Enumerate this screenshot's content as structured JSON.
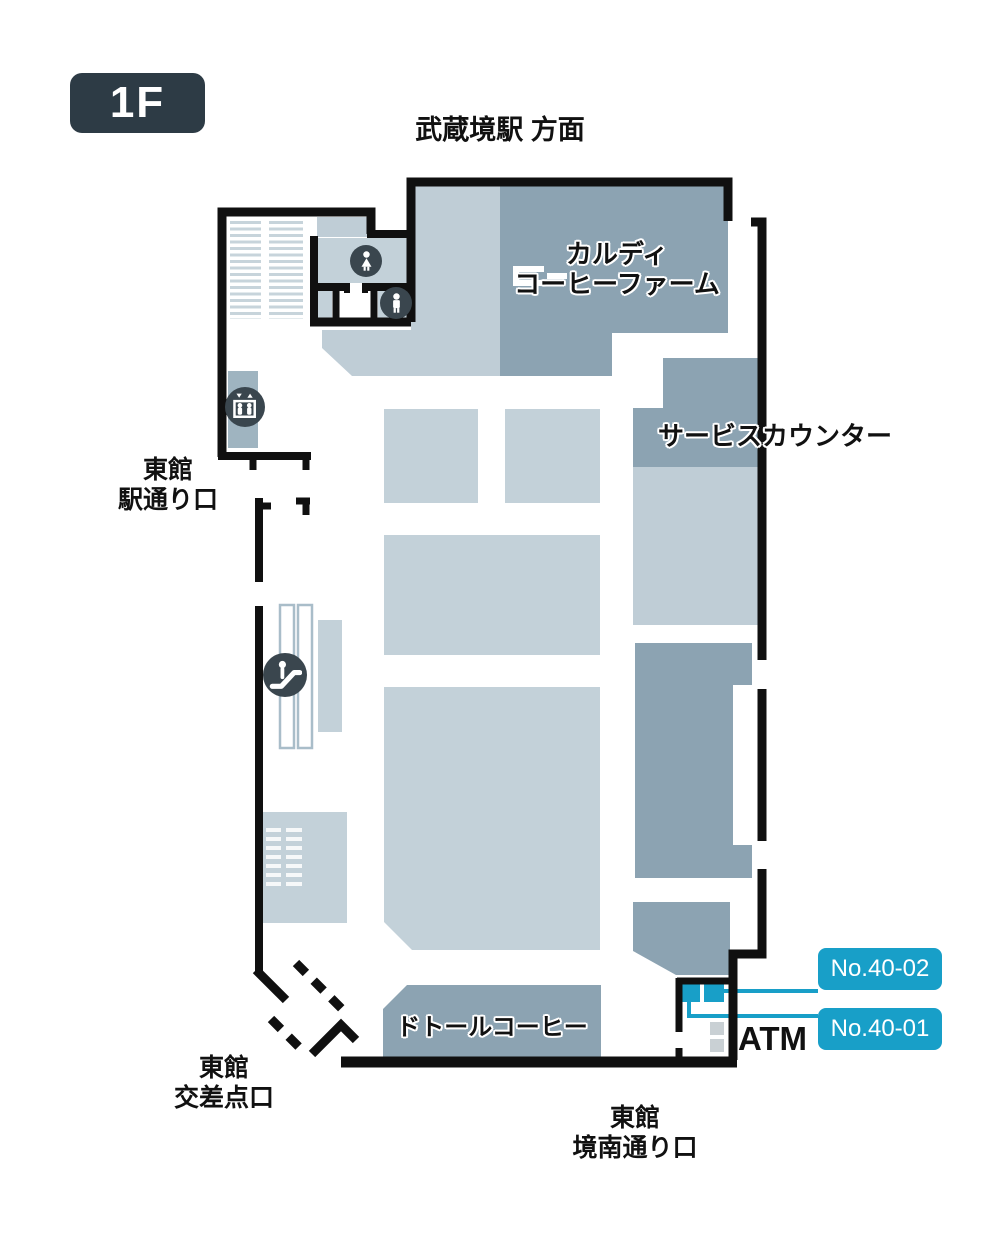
{
  "floor": {
    "badge": "1F"
  },
  "directions": {
    "top": "武蔵境駅 方面"
  },
  "areas": {
    "kaldi": {
      "line1": "カルディ",
      "line2": "コーヒーファーム"
    },
    "service_counter": {
      "label": "サービスカウンター"
    },
    "doutor": {
      "label": "ドトールコーヒー"
    },
    "atm": {
      "label": "ATM"
    }
  },
  "exits": {
    "station": {
      "line1": "東館",
      "line2": "駅通り口"
    },
    "intersection": {
      "line1": "東館",
      "line2": "交差点口"
    },
    "kyonan": {
      "line1": "東館",
      "line2": "境南通り口"
    }
  },
  "units": [
    {
      "id": "No.40-02"
    },
    {
      "id": "No.40-01"
    }
  ],
  "icons": {
    "women_restroom": "women-restroom-icon",
    "men_restroom": "men-restroom-icon",
    "elevator": "elevator-icon",
    "escalator": "escalator-icon",
    "gate": "store-gate-icon"
  },
  "colors": {
    "wall": "#101010",
    "area_light": "#bfcdd6",
    "fixture_light": "#c3d1d9",
    "area_dark": "#8ca3b2",
    "badge_bg": "#2d3b45",
    "icon_circle": "#3a464e",
    "highlight_blue": "#189fc8",
    "atm_gray": "#c9d0d4",
    "elevator_shaft": "#9fb4c0",
    "escalator_track": "#a9bdc9"
  }
}
